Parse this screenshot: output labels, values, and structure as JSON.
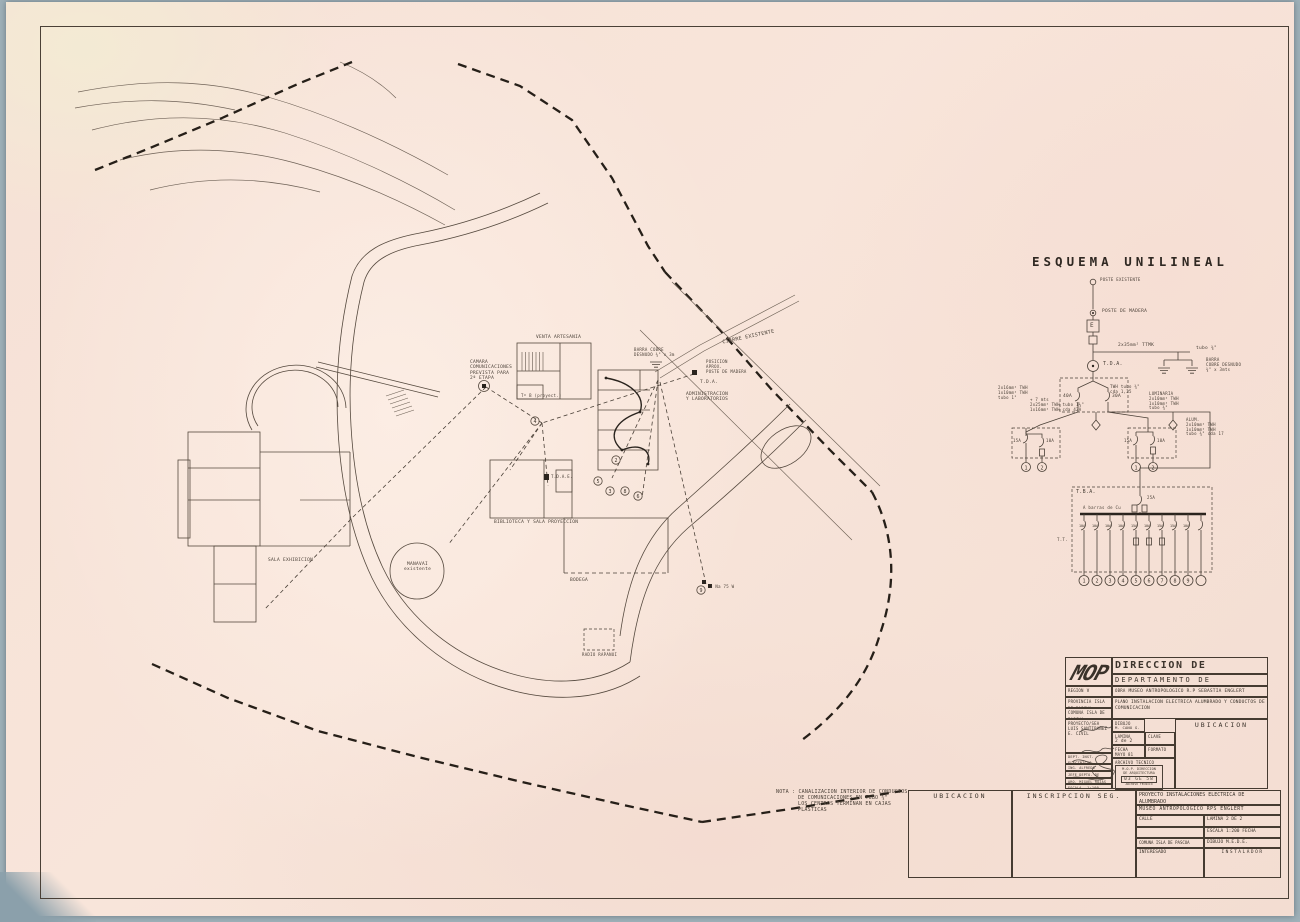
{
  "plan": {
    "labels": {
      "camara": [
        "CAMARA",
        "COMUNICACIONES",
        "PREVISTA PARA",
        "2ª ETAPA"
      ],
      "venta": "VENTA ARTESANIA",
      "cierre": "CIERRE EXISTENTE",
      "posicion": [
        "POSICION",
        "APROX.",
        "POSTE DE MADERA"
      ],
      "barra": [
        "BARRA COBRE",
        "DESNUDO ¾\" x 3m"
      ],
      "tda": "T.D.A.",
      "admin": [
        "ADMINISTRACION",
        "Y LABORATORIOS"
      ],
      "biblioteca": "BIBLIOTECA Y SALA PROYECCION",
      "sala_exhibicion": "SALA EXHIBICION",
      "manavai": [
        "MANAVAI",
        "existente"
      ],
      "bodega": "BODEGA",
      "radio": "RADIO RAPANUI",
      "tdae": "T.D.A.E.",
      "tob": "Tº B (proyect.)",
      "lum_se": "2 Na 75 W"
    },
    "circuits": [
      "4",
      "2",
      "5",
      "3",
      "8",
      "6",
      "9"
    ]
  },
  "esquema": {
    "title": "ESQUEMA UNILINEAL",
    "poste_existente": "POSTE EXISTENTE",
    "poste_madera": "POSTE DE MADERA",
    "medidor": "E",
    "tda": "T.D.A.",
    "acometida": "2x35mm² TTMK",
    "tubo": "tubo ¾\"",
    "barra": [
      "BARRA",
      "COBRE DESNUDO",
      "¾\" x 3mts"
    ],
    "br40": "40A",
    "br30": "30A",
    "feeder_left": [
      "2x16mm² TWH",
      "1x10mm² TWH",
      "tubo 1\""
    ],
    "feeder_mid": [
      "+ 7 mts",
      "2x25mm² TWH  tubo 1¼\"",
      "1x16mm² TWH  cda 42A"
    ],
    "feeder_right": [
      "TWH  tubo ¾\"",
      "cda 1,25"
    ],
    "lum": [
      "LUMINARIA",
      "2x10mm² TWH",
      "1x10mm² TWH",
      "tubo ¾\""
    ],
    "alum": [
      "ALUM.",
      "2x10mm² TWH",
      "1x10mm² TWH",
      "tubo ¾\"  cda 17"
    ],
    "pa_brk": [
      "15A",
      "10A"
    ],
    "pb_brk": [
      "15A",
      "10A"
    ],
    "pa_circ": [
      "1",
      "2"
    ],
    "pb_circ": [
      "1",
      "2"
    ],
    "tba": "T.B.A.",
    "main_brk": "25A",
    "bus": "A barras de Cu",
    "tt": "T.T.",
    "branches": [
      "10A",
      "10A",
      "10A",
      "10A",
      "15A",
      "10A",
      "15A",
      "15A",
      "10A",
      ""
    ],
    "circles": [
      "1",
      "2",
      "3",
      "4",
      "5",
      "6",
      "7",
      "8",
      "9",
      ""
    ]
  },
  "nota": [
    "NOTA : CANALIZACION INTERIOR DE CONDUCTOS",
    "DE COMUNICACIONES EN TUBO ¾\"",
    "LOS CENTROS TERMINAN EN CAJAS",
    "PLASTICAS"
  ],
  "mop": {
    "logo": "MOP",
    "line1": "DIRECCION DE ARQUITECTURA",
    "line2": "DEPARTAMENTO DE PROYECTOS",
    "region_l": "REGION",
    "region_v": "V",
    "obra_l": "OBRA",
    "obra_v": "MUSEO ANTROPOLOGICO R.P SEBASTIA ENGLERT",
    "prov_l": "PROVINCIA",
    "prov_v": "ISLA DE PASCUA",
    "com_l": "COMUNA",
    "com_v": "ISLA DE PASCUA",
    "plano_l": "PLANO",
    "plano_v": "INSTALACION ELECTRICA ALUMBRADO Y CONDUCTOS DE COMUNICACION",
    "proy_l": "PROYECTO/SEA",
    "proy_v1": "LUIS SANTIBAÑEZ",
    "proy_v2": "E. CIVIL",
    "dib_l": "DIBUJO",
    "dib_v": "M. CANO G.",
    "rev": "REV.",
    "ubicacion": "UBICACION",
    "lam_l": "LAMINA",
    "lam_v": "2 de 2",
    "clave": "CLAVE",
    "fecha_l": "FECHA",
    "fecha_v": "MAYO 81",
    "formato": "FORMATO",
    "archivo": "ARCHIVO TECNICO",
    "dept": "DEPT. INST. ELECTRICAS",
    "ing": "ING. ALFREDO TORRES W.",
    "jefe": "JEFE DEPTO. DE PROYECTOS",
    "arq": "ARQ. MIGUEL ROJAS T.",
    "esc_l": "ESCALA",
    "esc_v": "1:100",
    "lamn": "LAM. Nº",
    "stamp1": "M.O.P. DIRECCION",
    "stamp2": "DE ARQUITECTURA",
    "stamp_n": "03 GE 58",
    "stamp3": "ARCHIVO TECNICO"
  },
  "bottom": {
    "ubicacion": "UBICACION",
    "inscripcion": "INSCRIPCION SEG.",
    "t1a": "PROYECTO INSTALACIONES ELECTRICA DE",
    "t1b": "ALUMBRADO",
    "t2": "MUSEO ANTROPOLOGICO RPS ENGLERT",
    "calle": "CALLE",
    "lamina": "LAMINA 2  DE  2",
    "escala": "ESCALA 1:200 FECHA",
    "comuna": "COMUNA ISLA DE PASCUA",
    "dibujo": "DIBUJO  M.E.D.E.",
    "interesado": "INTERESADO",
    "instalador": "INSTALADOR"
  }
}
